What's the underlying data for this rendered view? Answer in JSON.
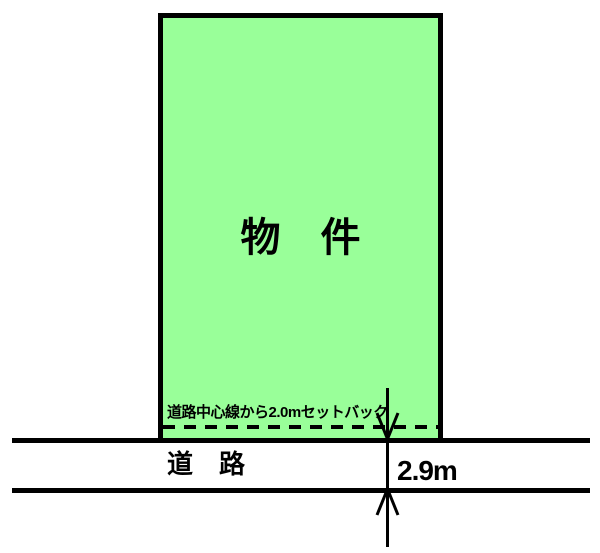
{
  "diagram": {
    "property_label": "物　件",
    "setback_note": "道路中心線から2.0mセットバック",
    "road_label": "道　路",
    "road_width": "2.9m"
  },
  "colors": {
    "property_fill": "#99ff99",
    "line_color": "#000000",
    "background": "#ffffff"
  }
}
